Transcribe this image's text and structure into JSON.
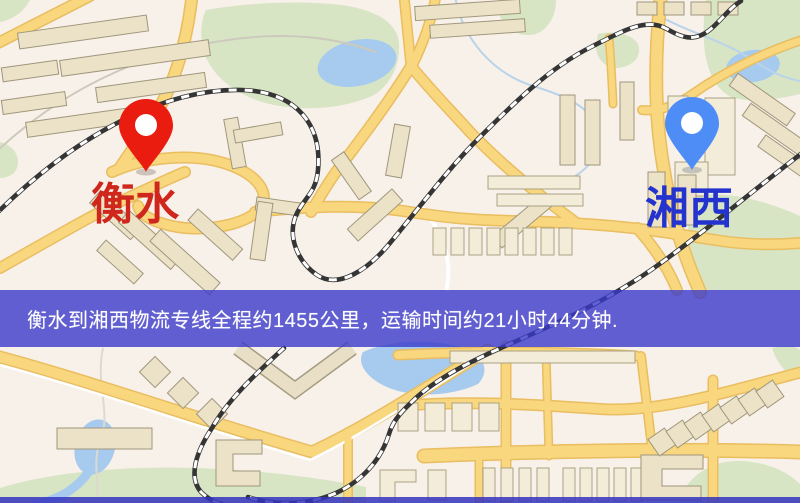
{
  "map": {
    "origin_marker": {
      "label": "衡水",
      "pin_color": "#ea1c10",
      "label_color": "#d0271d"
    },
    "destination_marker": {
      "label": "湘西",
      "pin_color": "#4f8df6",
      "label_color": "#2433cd"
    },
    "banner": {
      "text": "衡水到湘西物流专线全程约1455公里，运输时间约21小时44分钟.",
      "background_color": "#3a3ac9",
      "text_color": "#ffffff"
    },
    "route": {
      "origin": "衡水",
      "destination": "湘西",
      "distance_text": "约1455公里",
      "duration_text": "约21小时44分钟"
    }
  }
}
